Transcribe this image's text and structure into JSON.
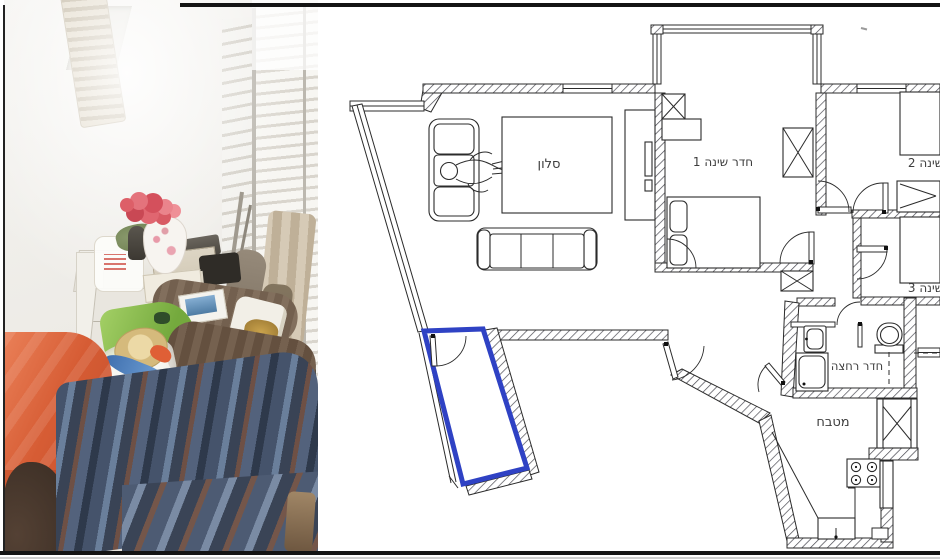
{
  "floor_plan": {
    "labels": {
      "living_room": "סלון",
      "bedroom1": "חדר שינה 1",
      "bedroom2": "חדר שינה 2",
      "bedroom3": "חדר שינה 3",
      "bathroom": "חדר רחצה",
      "kitchen": "מטבח"
    },
    "highlight_color": "#2f42c4",
    "wall_color": "#2b2b2b",
    "background": "#ffffff"
  },
  "photo": {
    "wall_color": "#f0eeea",
    "shutter_color": "#e8e5de",
    "orange_blanket_color": "#d65c34",
    "striped_blanket_color": "#45536b",
    "green_bag_color": "#86bb4e",
    "flowers_color": "#dd5f68",
    "straw_hat_color": "#e3cb93"
  }
}
